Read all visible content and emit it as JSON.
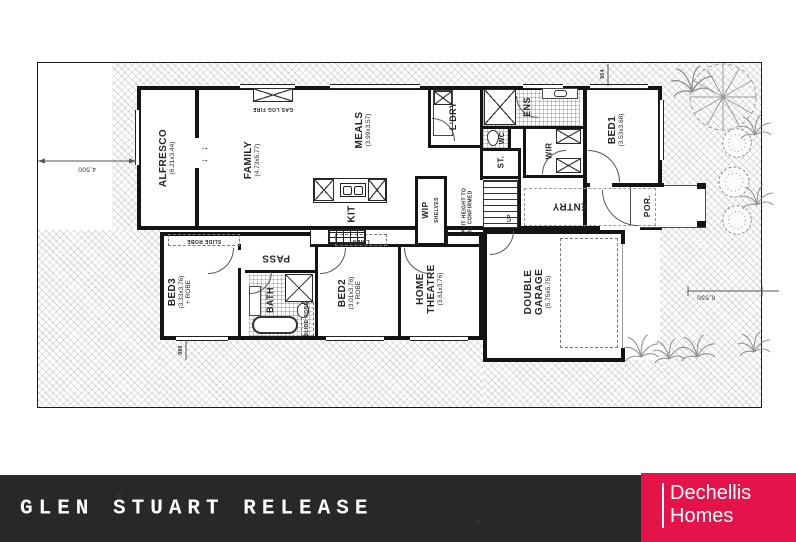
{
  "banner": {
    "title": "GLEN STUART RELEASE"
  },
  "logo": {
    "line1": "Dechellis",
    "line2": "Homes"
  },
  "colors": {
    "logo_red": "#e4134a",
    "banner_bg": "#29272a",
    "wall": "#141414"
  },
  "rooms": {
    "alfresco": {
      "name": "ALFRESCO",
      "dims": "(6.21x3.44)"
    },
    "family": {
      "name": "FAMILY",
      "dims": "(4.73x5.77)"
    },
    "meals": {
      "name": "MEALS",
      "dims": "(3.99x3.57)"
    },
    "kitchen": {
      "name": "KIT"
    },
    "wip": {
      "name": "WIP",
      "note": "SHELVES"
    },
    "laundry": {
      "name": "L'DRY"
    },
    "ensuite": {
      "name": "ENS"
    },
    "wc": {
      "name": "WC"
    },
    "store": {
      "name": "ST."
    },
    "wir": {
      "name": "WIR"
    },
    "bed1": {
      "name": "BED1",
      "dims": "(3.53x3.68)"
    },
    "entry": {
      "name": "ENTRY"
    },
    "porch": {
      "name": "POR."
    },
    "bed3": {
      "name": "BED3",
      "dims": "(3.33x3.76)",
      "note": "+ ROBE"
    },
    "bath": {
      "name": "BATH"
    },
    "bed2": {
      "name": "BED2",
      "dims": "(3.01x3.76)",
      "note": "+ ROBE"
    },
    "theatre": {
      "name": "HOME",
      "name2": "THEATRE",
      "dims": "(3.61x3.76)"
    },
    "garage": {
      "name": "DOUBLE",
      "name2": "GARAGE",
      "dims": "(5.75x5.75)"
    },
    "pass": {
      "name": "PASS"
    }
  },
  "annotations": {
    "gas_log_fire": "GAS LOG FIRE",
    "slide_robe_bed3": "SLIDE ROBE",
    "slide_robe_bed2": "SLIDE ROBE",
    "linen": "LINEN",
    "split_height_1": "SPLIT HEIGHT TO",
    "split_height_2": "BE CONFIRMED",
    "up": "UP"
  },
  "dimensions": {
    "front_setback": "4,500",
    "side_setback": "6,550",
    "top_small": "954",
    "bottom_small": "986"
  },
  "icons": {
    "door_swing_arrow": "→"
  }
}
